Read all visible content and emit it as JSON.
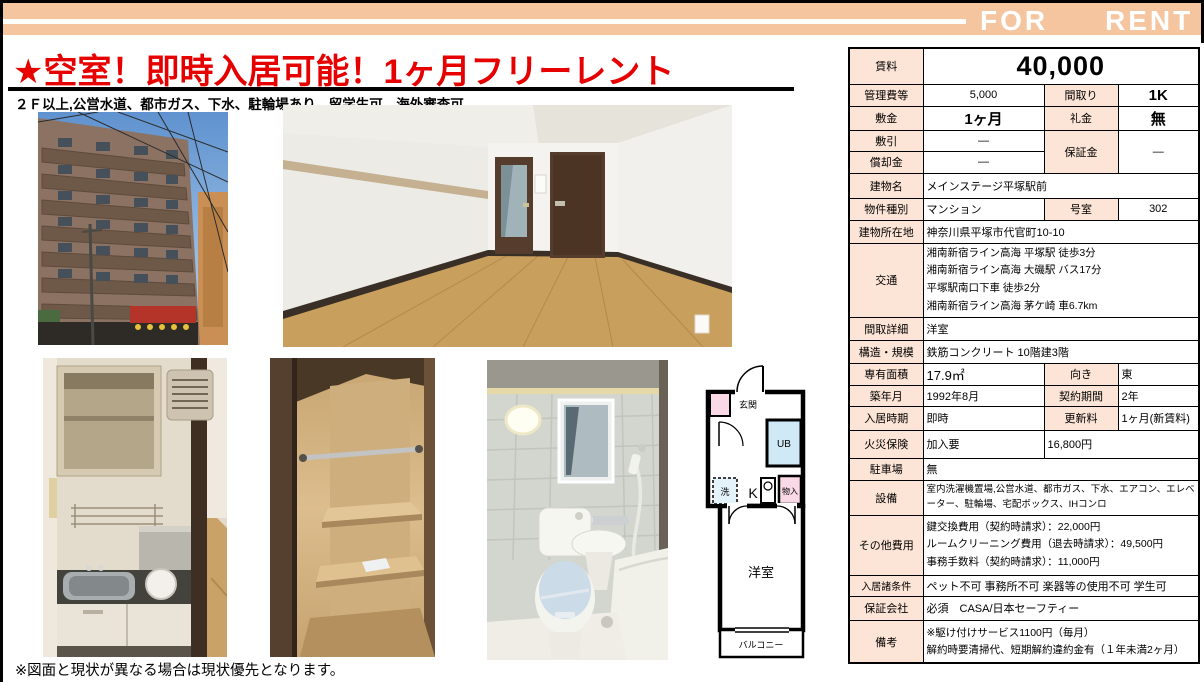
{
  "banner": {
    "for": "FOR",
    "rent": "RENT"
  },
  "header": {
    "title": "★空室！即時入居可能！1ヶ月フリーレント",
    "subtitle": "２Ｆ以上,公営水道、都市ガス、下水、駐輪場あり、留学生可、海外審査可"
  },
  "footer": {
    "note": "※図面と現状が異なる場合は現状優先となります。"
  },
  "colors": {
    "banner_peach": "#f5c59f",
    "label_peach": "#fce4d6",
    "title_red": "#e60000"
  },
  "floorplan": {
    "genkan": "玄関",
    "ub": "UB",
    "wash": "洗",
    "kitchen": "K",
    "closet": "物入",
    "room": "洋室",
    "balcony": "バルコニー"
  },
  "table": {
    "rent": {
      "label": "賃料",
      "value": "40,000"
    },
    "mgmt": {
      "label": "管理費等",
      "value": "5,000"
    },
    "madori": {
      "label": "間取り",
      "value": "1K"
    },
    "shikikin": {
      "label": "敷金",
      "value": "1ヶ月"
    },
    "reikin": {
      "label": "礼金",
      "value": "無"
    },
    "shikibiki": {
      "label": "敷引",
      "value": "—"
    },
    "hoshokin": {
      "label": "保証金",
      "value": "—"
    },
    "shokyaku": {
      "label": "償却金",
      "value": "—"
    },
    "building": {
      "label": "建物名",
      "value": "メインステージ平塚駅前"
    },
    "type": {
      "label": "物件種別",
      "value": "マンション"
    },
    "room_no": {
      "label": "号室",
      "value": "302"
    },
    "address": {
      "label": "建物所在地",
      "value": "神奈川県平塚市代官町10-10"
    },
    "access": {
      "label": "交通",
      "l1": "湘南新宿ライン高海 平塚駅 徒歩3分",
      "l2": "湘南新宿ライン高海 大磯駅 バス17分",
      "l3": "平塚駅南口下車 徒歩2分",
      "l4": "湘南新宿ライン高海 茅ケ崎 車6.7km"
    },
    "madori_detail": {
      "label": "間取詳細",
      "value": "洋室"
    },
    "structure": {
      "label": "構造・規模",
      "value": "鉄筋コンクリート 10階建3階"
    },
    "area": {
      "label": "専有面積",
      "value": "17.9㎡"
    },
    "facing": {
      "label": "向き",
      "value": "東"
    },
    "built": {
      "label": "築年月",
      "value": "1992年8月"
    },
    "contract": {
      "label": "契約期間",
      "value": "2年"
    },
    "movein": {
      "label": "入居時期",
      "value": "即時"
    },
    "renewal": {
      "label": "更新料",
      "value": "1ヶ月(新賃料)"
    },
    "fire": {
      "label": "火災保険",
      "value": "加入要",
      "cost": "16,800円"
    },
    "parking": {
      "label": "駐車場",
      "value": "無"
    },
    "equipment": {
      "label": "設備",
      "value": "室内洗濯機置場,公営水道、都市ガス、下水、エアコン、エレベーター、駐輪場、宅配ボックス、IHコンロ"
    },
    "other_fees": {
      "label": "その他費用",
      "l1": "鍵交換費用（契約時請求）：22,000円",
      "l2": "ルームクリーニング費用（退去時請求）：49,500円",
      "l3": "事務手数料（契約時請求）：11,000円"
    },
    "conditions": {
      "label": "入居諸条件",
      "value": "ペット不可 事務所不可 楽器等の使用不可 学生可"
    },
    "guarantor": {
      "label": "保証会社",
      "value": "必須　CASA/日本セーフティー"
    },
    "notes": {
      "label": "備考",
      "l1": "※駆け付けサービス1100円（毎月）",
      "l2": "解約時要清掃代、短期解約違約金有（１年未満2ヶ月）"
    }
  }
}
